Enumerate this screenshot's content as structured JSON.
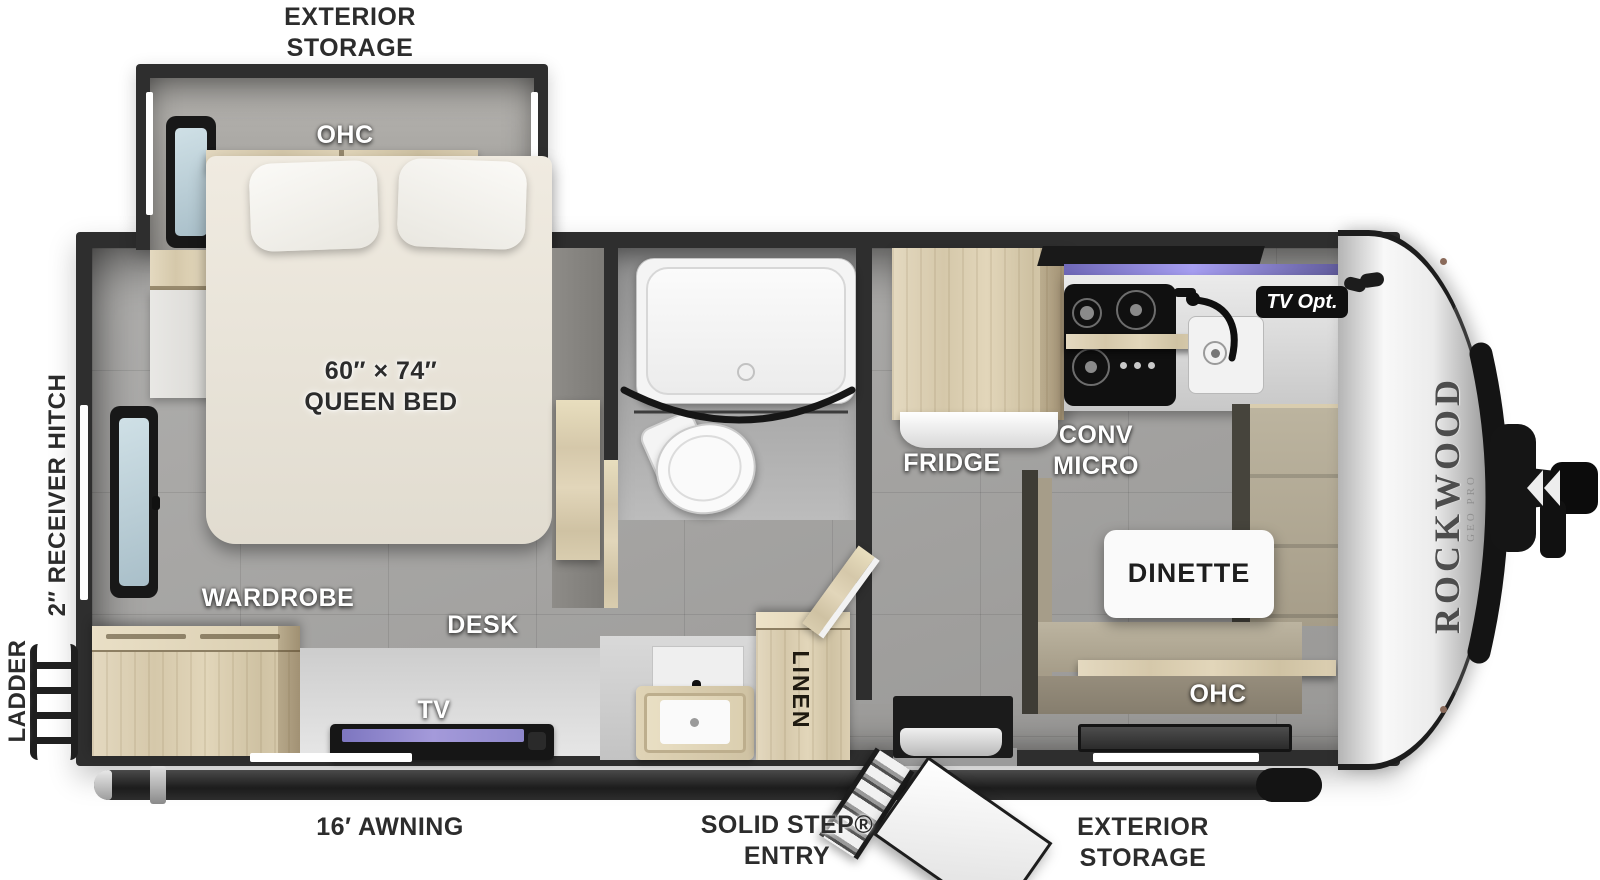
{
  "brand": {
    "name": "ROCKWOOD",
    "sub": "GEO PRO"
  },
  "exterior": {
    "storage_top": "EXTERIOR\nSTORAGE",
    "storage_bottom": "EXTERIOR\nSTORAGE",
    "receiver_hitch": "2″ RECEIVER HITCH",
    "ladder": "LADDER",
    "awning": "16′ AWNING",
    "entry": "SOLID STEP®\nENTRY"
  },
  "bedroom": {
    "ohc": "OHC",
    "bed_size": "60″ × 74″\nQUEEN BED",
    "wardrobe": "WARDROBE",
    "desk": "DESK",
    "tv": "TV"
  },
  "bath": {
    "linen": "LINEN"
  },
  "kitchen": {
    "fridge": "FRIDGE",
    "conv_micro": "CONV\nMICRO",
    "tv_opt": "TV Opt."
  },
  "dinette": {
    "label": "DINETTE",
    "ohc": "OHC"
  },
  "colors": {
    "wall": "#2e2e2e",
    "wood": "#dccfb0",
    "bench": "#b0a793",
    "led_accent": "#8d85d6",
    "floor": "#a6a5a3",
    "cap": "#ededed"
  }
}
